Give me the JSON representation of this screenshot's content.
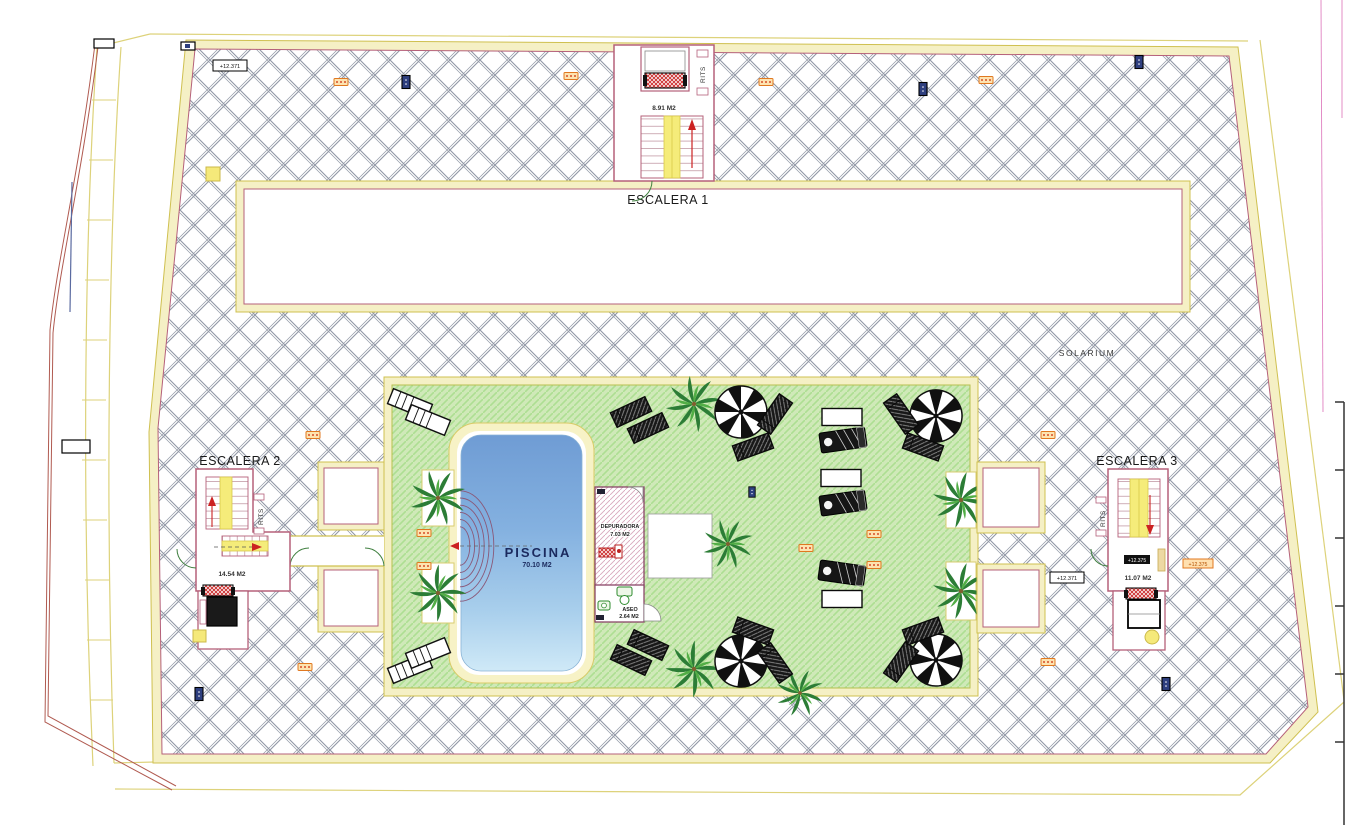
{
  "drawing": {
    "solarium_label": "SOLARIUM",
    "stairs": {
      "s1": {
        "name": "ESCALERA 1",
        "area": "8.91 M2",
        "riser": "RITS"
      },
      "s2": {
        "name": "ESCALERA 2",
        "area": "14.54 M2",
        "riser": "RITS"
      },
      "s3": {
        "name": "ESCALERA 3",
        "area": "11.07 M2",
        "riser": "RITS",
        "badge": "+12.375"
      }
    },
    "pool": {
      "name": "PISCINA",
      "area": "70.10 M2"
    },
    "rooms": {
      "depuradora": {
        "name": "DEPURADORA",
        "area": "7.03 M2"
      },
      "aseo": {
        "name": "ASEO",
        "area": "2.64 M2"
      }
    },
    "levels": {
      "top_left": "+12.371",
      "mid_right": "+12.371",
      "solarium_right": "+12.375"
    },
    "colors": {
      "hatch_line": "#9097a5",
      "band_fill": "#f5f0c5",
      "band_line": "#cfc050",
      "wall": "#b5607a",
      "lawn": "#cfe9b8",
      "lawn_line": "#addf92",
      "pool_deep": "#6f9cd4",
      "pool_shallow": "#cfe9f7",
      "stair_yellow": "#f5ec7a",
      "red": "#cc2222",
      "orange": "#e07820",
      "palm_green": "#2f8f3a"
    }
  }
}
